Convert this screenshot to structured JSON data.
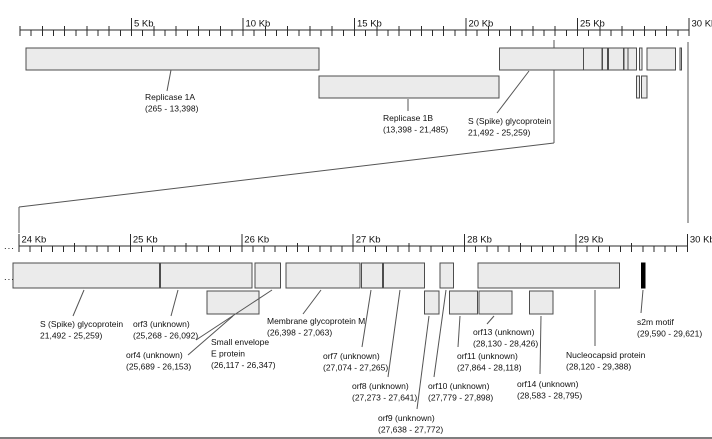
{
  "colors": {
    "background": "#ffffff",
    "box_fill": "#ebebeb",
    "box_border": "#4d4d4d",
    "connector_line": "#555555",
    "ruler_line": "#2b2b2b",
    "text": "#111111",
    "s2m_fill": "#000000"
  },
  "ellipsis": "...",
  "rulers": {
    "top": {
      "labels": [
        "5 Kb",
        "10 Kb",
        "15 Kb",
        "20 Kb",
        "25 Kb",
        "30 Kb"
      ]
    },
    "bottom": {
      "labels": [
        "24 Kb",
        "25 Kb",
        "26 Kb",
        "27 Kb",
        "28 Kb",
        "29 Kb",
        "30 Kb"
      ]
    }
  },
  "features": [
    {
      "id": "rep1a",
      "label": [
        "Replicase 1A",
        "(265 - 13,398)"
      ],
      "start_bp": 265,
      "end_bp": 13398
    },
    {
      "id": "rep1b",
      "label": [
        "Replicase 1B",
        "(13,398 - 21,485)"
      ],
      "start_bp": 13398,
      "end_bp": 21485
    },
    {
      "id": "spike",
      "label": [
        "S (Spike) glycoprotein",
        "21,492 - 25,259)"
      ],
      "start_bp": 21492,
      "end_bp": 25259
    },
    {
      "id": "orf3",
      "label": [
        "orf3 (unknown)",
        "(25,268 - 26,092)"
      ],
      "start_bp": 25268,
      "end_bp": 26092
    },
    {
      "id": "orf4",
      "label": [
        "orf4 (unknown)",
        "(25,689 - 26,153)"
      ],
      "start_bp": 25689,
      "end_bp": 26153
    },
    {
      "id": "e",
      "label": [
        "Small envelope",
        "E protein",
        "(26,117 - 26,347)"
      ],
      "start_bp": 26117,
      "end_bp": 26347
    },
    {
      "id": "m",
      "label": [
        "Membrane glycoprotein M",
        "(26,398 - 27,063)"
      ],
      "start_bp": 26398,
      "end_bp": 27063
    },
    {
      "id": "orf7",
      "label": [
        "orf7 (unknown)",
        "(27,074 - 27,265)"
      ],
      "start_bp": 27074,
      "end_bp": 27265
    },
    {
      "id": "orf8",
      "label": [
        "orf8 (unknown)",
        "(27,273 - 27,641)"
      ],
      "start_bp": 27273,
      "end_bp": 27641
    },
    {
      "id": "orf9",
      "label": [
        "orf9 (unknown)",
        "(27,638 - 27,772)"
      ],
      "start_bp": 27638,
      "end_bp": 27772
    },
    {
      "id": "orf10",
      "label": [
        "orf10 (unknown)",
        "(27,779 - 27,898)"
      ],
      "start_bp": 27779,
      "end_bp": 27898
    },
    {
      "id": "orf11",
      "label": [
        "orf11 (unknown)",
        "(27,864 - 28,118)"
      ],
      "start_bp": 27864,
      "end_bp": 28118
    },
    {
      "id": "orf13",
      "label": [
        "orf13 (unknown)",
        "(28,130 - 28,426)"
      ],
      "start_bp": 28130,
      "end_bp": 28426
    },
    {
      "id": "orf14",
      "label": [
        "orf14 (unknown)",
        "(28,583 - 28,795)"
      ],
      "start_bp": 28583,
      "end_bp": 28795
    },
    {
      "id": "n",
      "label": [
        "Nucleocapsid protein",
        "(28,120 - 29,388)"
      ],
      "start_bp": 28120,
      "end_bp": 29388
    },
    {
      "id": "s2m",
      "label": [
        "s2m motif",
        "(29,590 - 29,621)"
      ],
      "start_bp": 29590,
      "end_bp": 29621
    }
  ]
}
